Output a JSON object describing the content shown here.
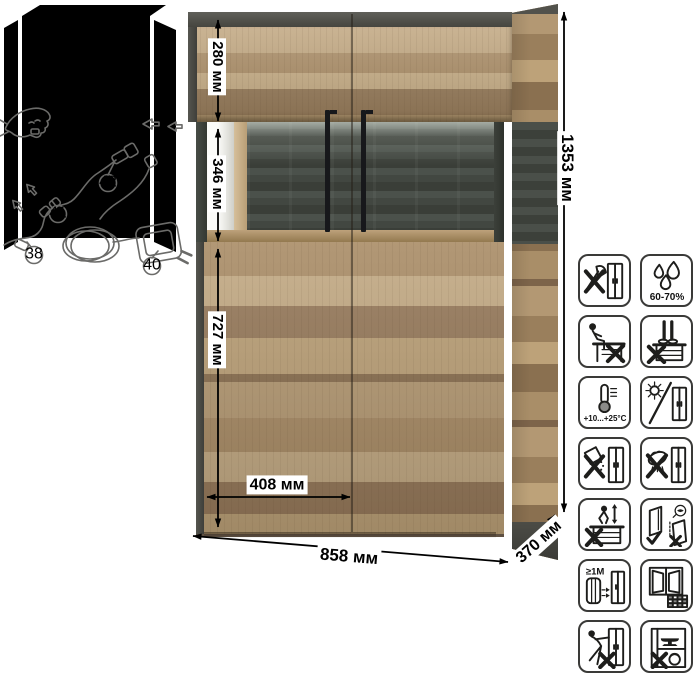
{
  "dims": {
    "d280": "280 мм",
    "d346": "346 мм",
    "d727": "727 мм",
    "d408": "408 мм",
    "d858": "858 мм",
    "d370": "370 мм",
    "d1353": "1353 мм"
  },
  "wiring": {
    "callout_38": "38",
    "callout_40": "40",
    "callout_41": "41",
    "callout_42": "42"
  },
  "shelf_load": {
    "value": "3",
    "unit": "kg"
  },
  "care": {
    "humidity_label": "60-70%",
    "temperature_label": "+10...+25°C",
    "distance_label": "≥1M",
    "icons": [
      "no-sharp-tools",
      "humidity-60-70",
      "no-sitting",
      "no-standing",
      "temperature-plus10-plus25",
      "avoid-direct-sunlight",
      "no-abrasive-cleaners",
      "no-wet-cleaning",
      "no-children-jumping",
      "transport-upright",
      "keep-1m-from-heat",
      "ventilated-room",
      "no-dragging",
      "no-overloading"
    ]
  },
  "colors": {
    "wood": "#b2946f",
    "trim": "#4b4b46",
    "glass_back": "#454a44",
    "handle": "#17181b",
    "dimension_line": "#000000",
    "icon_stroke": "#1d1d1b"
  }
}
